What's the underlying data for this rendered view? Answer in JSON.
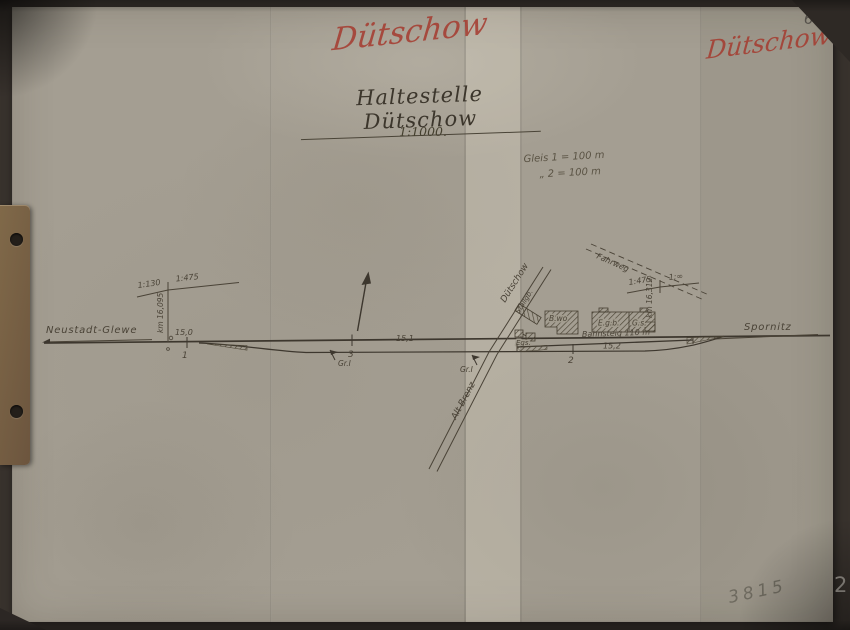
{
  "page": {
    "page_number": "64",
    "stamp_number": "3815",
    "corner_number": "2"
  },
  "red_annotations": {
    "center": "Dütschow",
    "right": "Dütschow"
  },
  "title": {
    "text": "Haltestelle Dütschow",
    "scale": "1:1000."
  },
  "legend": {
    "line1": "Gleis 1 = 100 m",
    "line2": "„  2 = 100 m"
  },
  "map": {
    "destinations": {
      "left": "Neustadt-Glewe",
      "right": "Spornitz"
    },
    "switch_numbers": {
      "s1": "1",
      "s2": "2",
      "s3": "3"
    },
    "boundary_marks": {
      "m1": "Gr.I",
      "m2": "Gr.I"
    },
    "distances": {
      "d0": "15,0",
      "d1": "15,1",
      "d2": "15,2"
    },
    "gradients": {
      "left_first": "1:130",
      "left_second": "1:475",
      "right_first": "1:475",
      "right_second": "1:∞"
    },
    "km_posts": {
      "left": "km 16,095",
      "right": "km 16,312"
    },
    "roads": {
      "village": "Dütschow",
      "crossing": "Alt Brenz",
      "farm": "Fahrweg"
    },
    "buildings": {
      "shed": "Stallgb.",
      "outbuilding": "Egs.",
      "dwelling": "B.wo",
      "station": "E.g.b.",
      "goods_shed": "G.s."
    },
    "platform_label": "Bahnsteig 110 m"
  },
  "colors": {
    "paper": "#a49e92",
    "ink": "#4a4337",
    "red": "#a43a2e",
    "backdrop": "#38322d",
    "tab": "#776044"
  }
}
